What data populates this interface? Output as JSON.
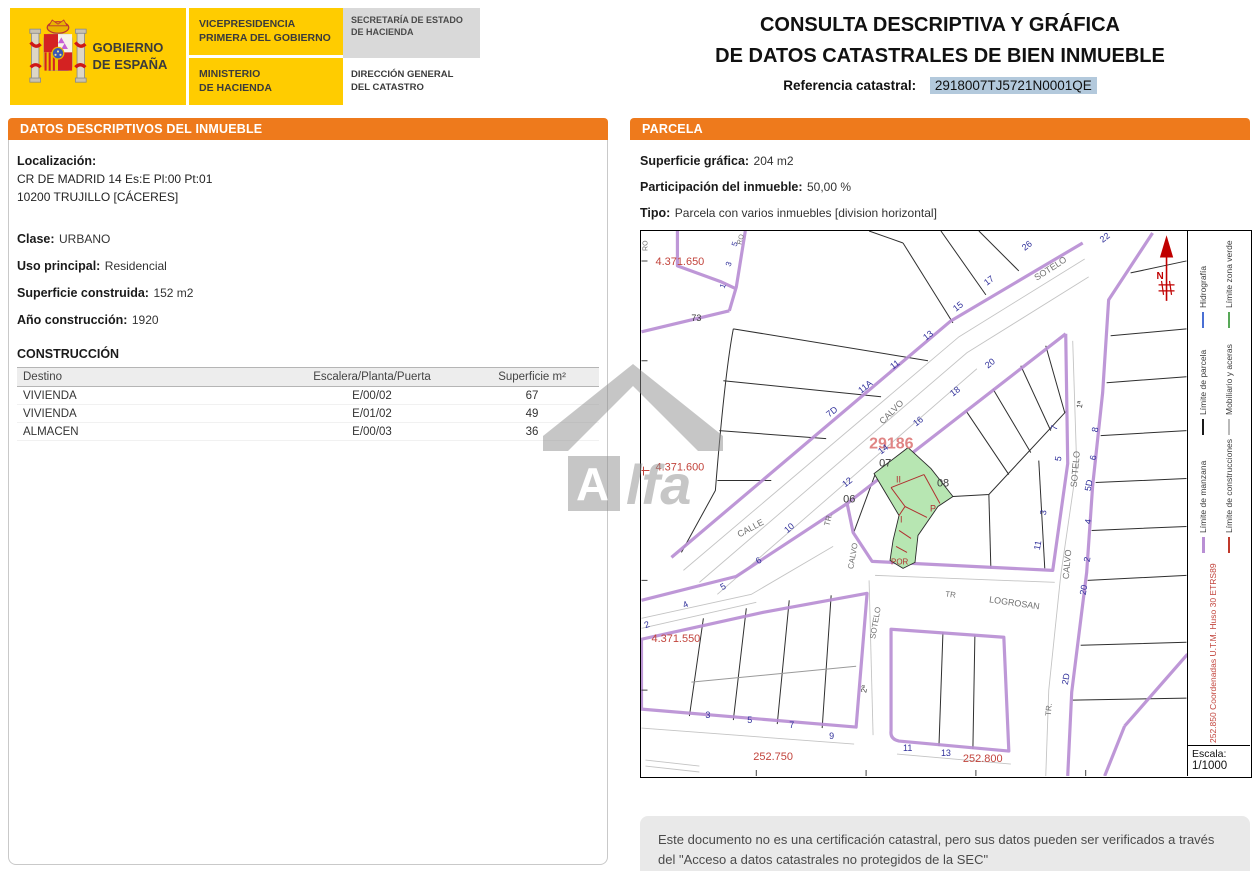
{
  "header": {
    "gobierno": "GOBIERNO\nDE ESPAÑA",
    "vicepresidencia": "VICEPRESIDENCIA\nPRIMERA DEL GOBIERNO",
    "ministerio": "MINISTERIO\nDE HACIENDA",
    "secretaria": "SECRETARÍA DE ESTADO\nDE HACIENDA",
    "direccion": "DIRECCIÓN GENERAL\nDEL CATASTRO"
  },
  "title": {
    "line1": "CONSULTA DESCRIPTIVA Y GRÁFICA",
    "line2": "DE DATOS CATASTRALES DE BIEN INMUEBLE",
    "ref_label": "Referencia catastral:",
    "ref_value": "2918007TJ5721N0001QE"
  },
  "inmueble": {
    "section_title": "DATOS DESCRIPTIVOS DEL INMUEBLE",
    "localizacion_label": "Localización:",
    "localizacion_line1": "CR DE MADRID 14 Es:E Pl:00 Pt:01",
    "localizacion_line2": "10200 TRUJILLO [CÁCERES]",
    "clase_label": "Clase:",
    "clase": "URBANO",
    "uso_label": "Uso principal:",
    "uso": "Residencial",
    "superficie_label": "Superficie construida:",
    "superficie": "152 m2",
    "anio_label": "Año construcción:",
    "anio": "1920"
  },
  "construccion": {
    "title": "CONSTRUCCIÓN",
    "headers": [
      "Destino",
      "Escalera/Planta/Puerta",
      "Superficie m²"
    ],
    "rows": [
      {
        "destino": "VIVIENDA",
        "escalera": "E/00/02",
        "superficie": "67"
      },
      {
        "destino": "VIVIENDA",
        "escalera": "E/01/02",
        "superficie": "49"
      },
      {
        "destino": "ALMACEN",
        "escalera": "E/00/03",
        "superficie": "36"
      }
    ]
  },
  "parcela": {
    "section_title": "PARCELA",
    "superficie_label": "Superficie gráfica:",
    "superficie": "204 m2",
    "participacion_label": "Participación del inmueble:",
    "participacion": "50,00 %",
    "tipo_label": "Tipo:",
    "tipo": "Parcela con varios inmuebles [division horizontal]",
    "legend": {
      "items": [
        {
          "label": "Límite de manzana",
          "color": "#b98fd4"
        },
        {
          "label": "Límite de construcciones",
          "color": "#c0392b"
        },
        {
          "label": "Límite de parcela",
          "color": "#1a1a1a"
        },
        {
          "label": "Mobiliario y aceras",
          "color": "#b9b9b9"
        },
        {
          "label": "Hidrografía",
          "color": "#4a6fd4"
        },
        {
          "label": "Límite zona verde",
          "color": "#58a858"
        }
      ],
      "coords_note": "252.850 Coordenadas U.T.M. Huso 30 ETRS89",
      "escala_label": "Escala:",
      "escala_value": "1/1000"
    }
  },
  "footer": {
    "note": "Este documento no es una certificación catastral, pero sus datos pueden ser verificados a través del \"Acceso a datos catastrales no protegidos de la SEC\""
  },
  "watermark": {
    "text_a": "A",
    "text_rest": "lfa"
  },
  "map": {
    "colors": {
      "red": "#c2443c",
      "blue": "#31319b",
      "gray": "#707070",
      "dark": "#3a3a3a",
      "pink": "#e08585",
      "redc": "#b03030",
      "north": "#c00000"
    },
    "labels": [
      {
        "t": "4.371.650",
        "x": 14,
        "y": 34,
        "c": "red",
        "s": 11
      },
      {
        "t": "4.371.600",
        "x": 14,
        "y": 240,
        "c": "red",
        "s": 11
      },
      {
        "t": "4.371.550",
        "x": 10,
        "y": 412,
        "c": "red",
        "s": 11
      },
      {
        "t": "252.750",
        "x": 112,
        "y": 530,
        "c": "red",
        "s": 11
      },
      {
        "t": "252.800",
        "x": 322,
        "y": 532,
        "c": "red",
        "s": 11
      },
      {
        "t": "29186",
        "x": 228,
        "y": 218,
        "c": "pink",
        "s": 16,
        "b": 1
      },
      {
        "t": "POR",
        "x": 250,
        "y": 334,
        "c": "redc",
        "s": 8
      },
      {
        "t": "07",
        "x": 238,
        "y": 236,
        "c": "dark",
        "s": 11
      },
      {
        "t": "08",
        "x": 296,
        "y": 256,
        "c": "dark",
        "s": 11
      },
      {
        "t": "06",
        "x": 202,
        "y": 272,
        "c": "dark",
        "s": 11
      },
      {
        "t": "II",
        "x": 255,
        "y": 252,
        "c": "redc",
        "s": 9
      },
      {
        "t": "I",
        "x": 259,
        "y": 292,
        "c": "redc",
        "s": 9
      },
      {
        "t": "P",
        "x": 289,
        "y": 281,
        "c": "redc",
        "s": 9
      },
      {
        "t": "73",
        "x": 50,
        "y": 90,
        "c": "dark",
        "s": 9
      },
      {
        "t": "7D",
        "x": 188,
        "y": 187,
        "c": "blue",
        "s": 9,
        "r": -38
      },
      {
        "t": "11A",
        "x": 220,
        "y": 163,
        "c": "blue",
        "s": 9,
        "r": -38
      },
      {
        "t": "11",
        "x": 252,
        "y": 139,
        "c": "blue",
        "s": 9,
        "r": -38
      },
      {
        "t": "13",
        "x": 285,
        "y": 110,
        "c": "blue",
        "s": 9,
        "r": -38
      },
      {
        "t": "15",
        "x": 315,
        "y": 81,
        "c": "blue",
        "s": 9,
        "r": -38
      },
      {
        "t": "17",
        "x": 346,
        "y": 55,
        "c": "blue",
        "s": 9,
        "r": -38
      },
      {
        "t": "26",
        "x": 384,
        "y": 20,
        "c": "blue",
        "s": 9,
        "r": -38
      },
      {
        "t": "12",
        "x": 204,
        "y": 257,
        "c": "blue",
        "s": 9,
        "r": -38
      },
      {
        "t": "14",
        "x": 240,
        "y": 224,
        "c": "blue",
        "s": 9,
        "r": -38
      },
      {
        "t": "16",
        "x": 275,
        "y": 196,
        "c": "blue",
        "s": 9,
        "r": -38
      },
      {
        "t": "18",
        "x": 312,
        "y": 166,
        "c": "blue",
        "s": 9,
        "r": -38
      },
      {
        "t": "20",
        "x": 347,
        "y": 138,
        "c": "blue",
        "s": 9,
        "r": -38
      },
      {
        "t": "22",
        "x": 462,
        "y": 12,
        "c": "blue",
        "s": 9,
        "r": -38
      },
      {
        "t": "1",
        "x": 83,
        "y": 58,
        "c": "blue",
        "s": 8,
        "r": -70
      },
      {
        "t": "3",
        "x": 89,
        "y": 36,
        "c": "blue",
        "s": 8,
        "r": -70
      },
      {
        "t": "5",
        "x": 95,
        "y": 16,
        "c": "blue",
        "s": 8,
        "r": -70
      },
      {
        "t": "2",
        "x": 4,
        "y": 398,
        "c": "blue",
        "s": 9,
        "r": -20
      },
      {
        "t": "4",
        "x": 43,
        "y": 378,
        "c": "blue",
        "s": 9,
        "r": -25
      },
      {
        "t": "5",
        "x": 81,
        "y": 360,
        "c": "blue",
        "s": 9,
        "r": -30
      },
      {
        "t": "6",
        "x": 117,
        "y": 334,
        "c": "blue",
        "s": 9,
        "r": -35
      },
      {
        "t": "10",
        "x": 146,
        "y": 303,
        "c": "blue",
        "s": 9,
        "r": -40
      },
      {
        "t": "3",
        "x": 64,
        "y": 488,
        "c": "blue",
        "s": 9
      },
      {
        "t": "5",
        "x": 106,
        "y": 493,
        "c": "blue",
        "s": 9
      },
      {
        "t": "7",
        "x": 148,
        "y": 498,
        "c": "blue",
        "s": 9
      },
      {
        "t": "9",
        "x": 188,
        "y": 509,
        "c": "blue",
        "s": 9
      },
      {
        "t": "11",
        "x": 262,
        "y": 521,
        "c": "blue",
        "s": 9
      },
      {
        "t": "13",
        "x": 300,
        "y": 526,
        "c": "blue",
        "s": 9
      },
      {
        "t": "7",
        "x": 416,
        "y": 200,
        "c": "blue",
        "s": 9,
        "r": -80
      },
      {
        "t": "5",
        "x": 420,
        "y": 231,
        "c": "blue",
        "s": 9,
        "r": -80
      },
      {
        "t": "3",
        "x": 405,
        "y": 285,
        "c": "blue",
        "s": 9,
        "r": -80
      },
      {
        "t": "11",
        "x": 399,
        "y": 320,
        "c": "blue",
        "s": 9,
        "r": -80
      },
      {
        "t": "8",
        "x": 457,
        "y": 202,
        "c": "blue",
        "s": 9,
        "r": -80
      },
      {
        "t": "6",
        "x": 455,
        "y": 230,
        "c": "blue",
        "s": 9,
        "r": -80
      },
      {
        "t": "5D",
        "x": 450,
        "y": 261,
        "c": "blue",
        "s": 9,
        "r": -80
      },
      {
        "t": "4",
        "x": 450,
        "y": 294,
        "c": "blue",
        "s": 9,
        "r": -80
      },
      {
        "t": "2",
        "x": 449,
        "y": 332,
        "c": "blue",
        "s": 9,
        "r": -80
      },
      {
        "t": "20",
        "x": 445,
        "y": 365,
        "c": "blue",
        "s": 9,
        "r": -80
      },
      {
        "t": "2D",
        "x": 427,
        "y": 455,
        "c": "blue",
        "s": 9,
        "r": -80
      },
      {
        "t": "1ª",
        "x": 441,
        "y": 178,
        "c": "dark",
        "s": 8,
        "r": -80
      },
      {
        "t": "2ª",
        "x": 225,
        "y": 463,
        "c": "dark",
        "s": 8,
        "r": -80
      },
      {
        "t": "SOTELO",
        "x": 396,
        "y": 50,
        "c": "gray",
        "s": 9,
        "r": -33
      },
      {
        "t": "CALVO",
        "x": 242,
        "y": 194,
        "c": "gray",
        "s": 9,
        "r": -45
      },
      {
        "t": "CALLE",
        "x": 98,
        "y": 307,
        "c": "gray",
        "s": 9,
        "r": -28
      },
      {
        "t": "TR.",
        "x": 188,
        "y": 296,
        "c": "gray",
        "s": 8,
        "r": -75
      },
      {
        "t": "CALVO",
        "x": 212,
        "y": 339,
        "c": "gray",
        "s": 8,
        "r": -80
      },
      {
        "t": "SOTELO",
        "x": 234,
        "y": 409,
        "c": "gray",
        "s": 8,
        "r": -80
      },
      {
        "t": "SOTELO",
        "x": 436,
        "y": 257,
        "c": "gray",
        "s": 9,
        "r": -85
      },
      {
        "t": "CALVO",
        "x": 428,
        "y": 349,
        "c": "gray",
        "s": 9,
        "r": -85
      },
      {
        "t": "TR.",
        "x": 410,
        "y": 486,
        "c": "gray",
        "s": 8,
        "r": -85
      },
      {
        "t": "TR",
        "x": 304,
        "y": 366,
        "c": "gray",
        "s": 8,
        "r": 8
      },
      {
        "t": "LOGROSAN",
        "x": 348,
        "y": 372,
        "c": "gray",
        "s": 9,
        "r": 8
      },
      {
        "t": "RO",
        "x": 6,
        "y": 20,
        "c": "gray",
        "s": 7,
        "r": -90
      },
      {
        "t": "RO",
        "x": 100,
        "y": 14,
        "c": "gray",
        "s": 7,
        "r": -75
      },
      {
        "t": "N",
        "x": 516,
        "y": 48,
        "c": "north",
        "s": 10,
        "b": 1
      }
    ]
  }
}
